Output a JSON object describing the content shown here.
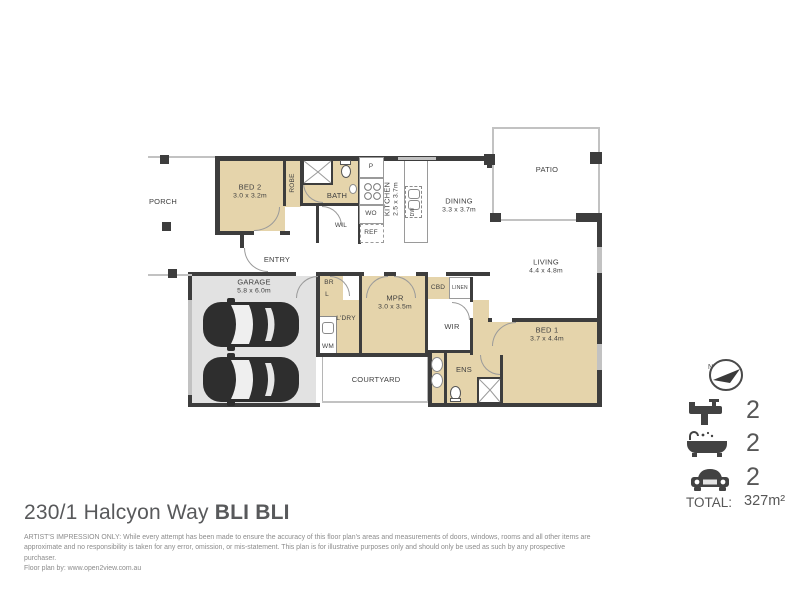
{
  "plan": {
    "rooms": {
      "porch": {
        "name": "PORCH"
      },
      "bed2": {
        "name": "BED 2",
        "dims": "3.0 x 3.2m"
      },
      "robe": {
        "name": "ROBE"
      },
      "bath": {
        "name": "BATH"
      },
      "wil": {
        "name": "WIL"
      },
      "pantry": {
        "name": "P"
      },
      "wall_oven": {
        "name": "WO"
      },
      "fridge": {
        "name": "REF"
      },
      "kitchen": {
        "name": "KITCHEN",
        "dims": "2.5 x 3.7m"
      },
      "dishwasher": {
        "name": "DW"
      },
      "dining": {
        "name": "DINING",
        "dims": "3.3 x 3.7m"
      },
      "patio": {
        "name": "PATIO"
      },
      "living": {
        "name": "LIVING",
        "dims": "4.4 x 4.8m"
      },
      "entry": {
        "name": "ENTRY"
      },
      "garage": {
        "name": "GARAGE",
        "dims": "5.8 x 6.0m"
      },
      "br": {
        "name": "BR"
      },
      "l": {
        "name": "L"
      },
      "laundry": {
        "name": "L'DRY"
      },
      "wm": {
        "name": "WM"
      },
      "mpr": {
        "name": "MPR",
        "dims": "3.0 x 3.5m"
      },
      "cbd": {
        "name": "CBD"
      },
      "linen": {
        "name": "LINEN"
      },
      "wir": {
        "name": "WIR"
      },
      "courtyard": {
        "name": "COURTYARD"
      },
      "ens": {
        "name": "ENS"
      },
      "bed1": {
        "name": "BED 1",
        "dims": "3.7 x 4.4m"
      }
    }
  },
  "legend": {
    "compass": "N",
    "taps": "2",
    "baths": "2",
    "cars": "2",
    "total_label": "TOTAL:",
    "total_value": "327m²"
  },
  "footer": {
    "title_main": "230/1 Halcyon Way ",
    "title_suffix": "BLI BLI",
    "disclaimer_line1": "ARTIST'S IMPRESSION ONLY: While every attempt has been made to ensure the accuracy of this floor plan's areas and measurements of doors, windows, rooms and all other items are",
    "disclaimer_line2": "approximate and no responsibility is taken for any error, omission, or mis-statement. This plan is for illustrative purposes only and should only be used as such by any prospective purchaser.",
    "disclaimer_line3": "Floor plan by: www.open2view.com.au"
  },
  "colors": {
    "wall": "#3d3d3d",
    "room_fill": "#e5d4ab",
    "garage_fill": "#e2e2e2",
    "line": "#c2c2c2"
  }
}
